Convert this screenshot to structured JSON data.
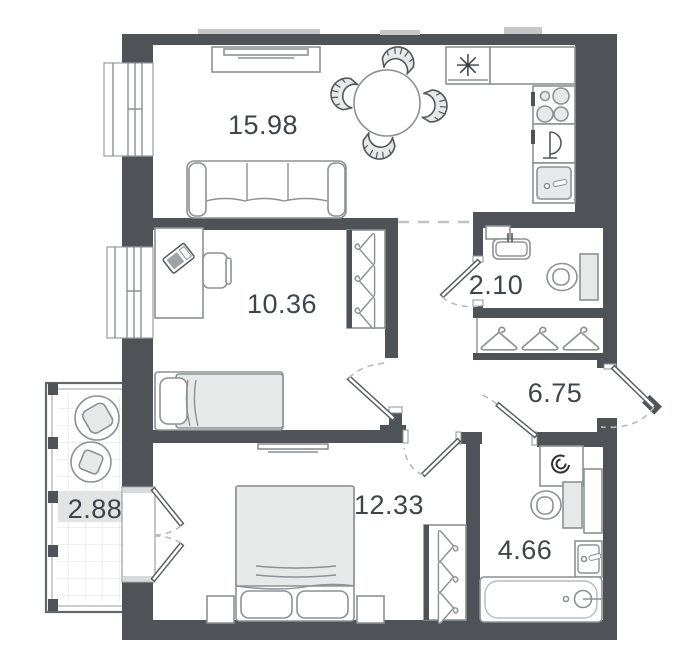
{
  "plan": {
    "type": "apartment-floor-plan",
    "rooms": [
      {
        "id": "living-kitchen",
        "area": "15.98"
      },
      {
        "id": "bedroom",
        "area": "10.36"
      },
      {
        "id": "wc",
        "area": "2.10"
      },
      {
        "id": "hallway",
        "area": "6.75"
      },
      {
        "id": "bedroom-master",
        "area": "12.33"
      },
      {
        "id": "bathroom",
        "area": "4.66"
      },
      {
        "id": "balcony",
        "area": "2.88"
      }
    ],
    "symbols": {
      "fridge_snowflake": "✳"
    },
    "colors": {
      "wall": "#4f5357",
      "furniture_stroke": "#8d9194",
      "furniture_fill": "#e7e8e8",
      "label_text": "#3f444a",
      "balcony_highlight": "#e2e3e3"
    }
  }
}
